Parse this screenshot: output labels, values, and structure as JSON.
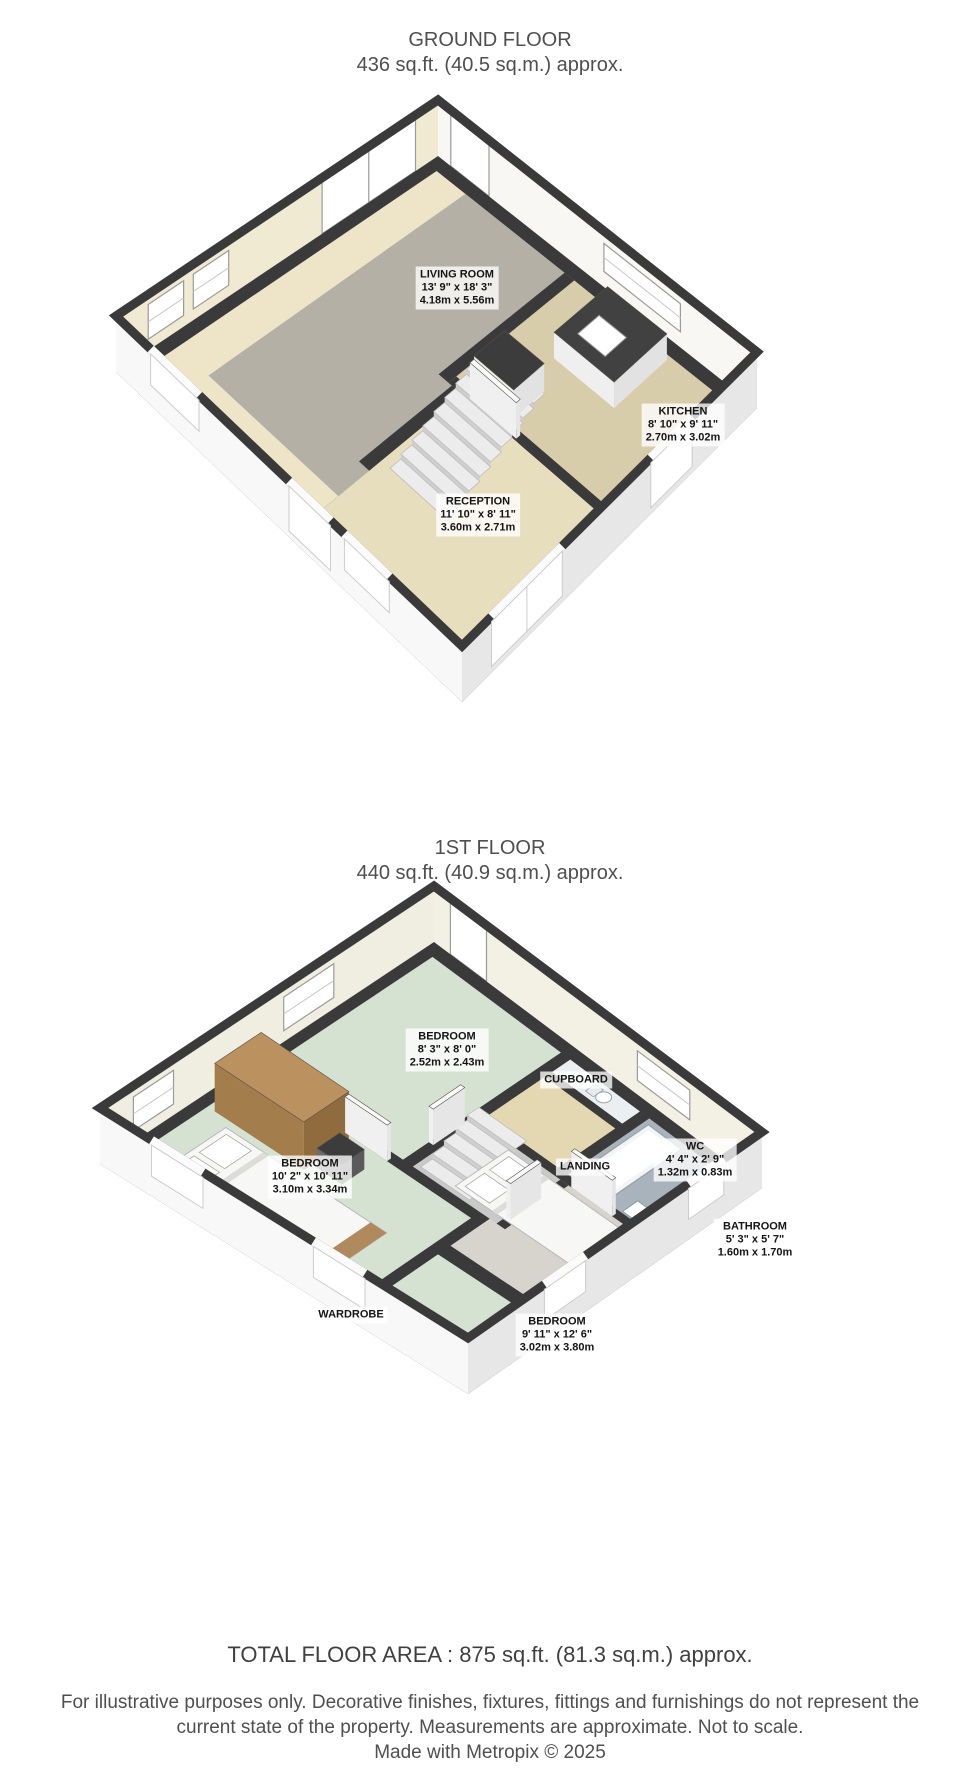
{
  "ground_floor": {
    "title": "GROUND FLOOR",
    "area": "436 sq.ft. (40.5 sq.m.) approx.",
    "rooms": [
      {
        "name": "LIVING ROOM",
        "dims_ft": "13' 9\" x 18' 3\"",
        "dims_m": "4.18m x 5.56m"
      },
      {
        "name": "KITCHEN",
        "dims_ft": "8' 10\" x 9' 11\"",
        "dims_m": "2.70m x 3.02m"
      },
      {
        "name": "RECEPTION",
        "dims_ft": "11' 10\" x 8' 11\"",
        "dims_m": "3.60m x 2.71m"
      }
    ]
  },
  "first_floor": {
    "title": "1ST FLOOR",
    "area": "440 sq.ft. (40.9 sq.m.) approx.",
    "rooms": [
      {
        "name": "BEDROOM",
        "dims_ft": "8' 3\" x 8' 0\"",
        "dims_m": "2.52m x 2.43m"
      },
      {
        "name": "CUPBOARD",
        "dims_ft": "",
        "dims_m": ""
      },
      {
        "name": "BEDROOM",
        "dims_ft": "10' 2\" x 10' 11\"",
        "dims_m": "3.10m x 3.34m"
      },
      {
        "name": "LANDING",
        "dims_ft": "",
        "dims_m": ""
      },
      {
        "name": "WC",
        "dims_ft": "4' 4\" x 2' 9\"",
        "dims_m": "1.32m x 0.83m"
      },
      {
        "name": "BATHROOM",
        "dims_ft": "5' 3\" x 5' 7\"",
        "dims_m": "1.60m x 1.70m"
      },
      {
        "name": "WARDROBE",
        "dims_ft": "",
        "dims_m": ""
      },
      {
        "name": "BEDROOM",
        "dims_ft": "9' 11\" x 12' 6\"",
        "dims_m": "3.02m x 3.80m"
      }
    ]
  },
  "footer": {
    "total_area": "TOTAL FLOOR AREA : 875 sq.ft. (81.3 sq.m.) approx.",
    "disclaimer": "For illustrative purposes only. Decorative finishes, fixtures, fittings and furnishings do not represent the current state of the property. Measurements are approximate. Not to scale.",
    "credit": "Made with Metropix © 2025"
  },
  "colors": {
    "wall": "#3a3a3a",
    "carpet_gray": "#b4b0a5",
    "cream": "#eee5c8",
    "beige": "#e7debe",
    "kitchen_tan": "#d8cdab",
    "mint": "#d5e1d1",
    "bathroom_blue": "#a9b3bc",
    "landing_gray": "#c9c9c9",
    "bedroom_gray": "#d6d4cd",
    "cupboard_tan": "#e4d8b2",
    "wc_white": "#eceff1",
    "wood": "#b08a5c"
  }
}
